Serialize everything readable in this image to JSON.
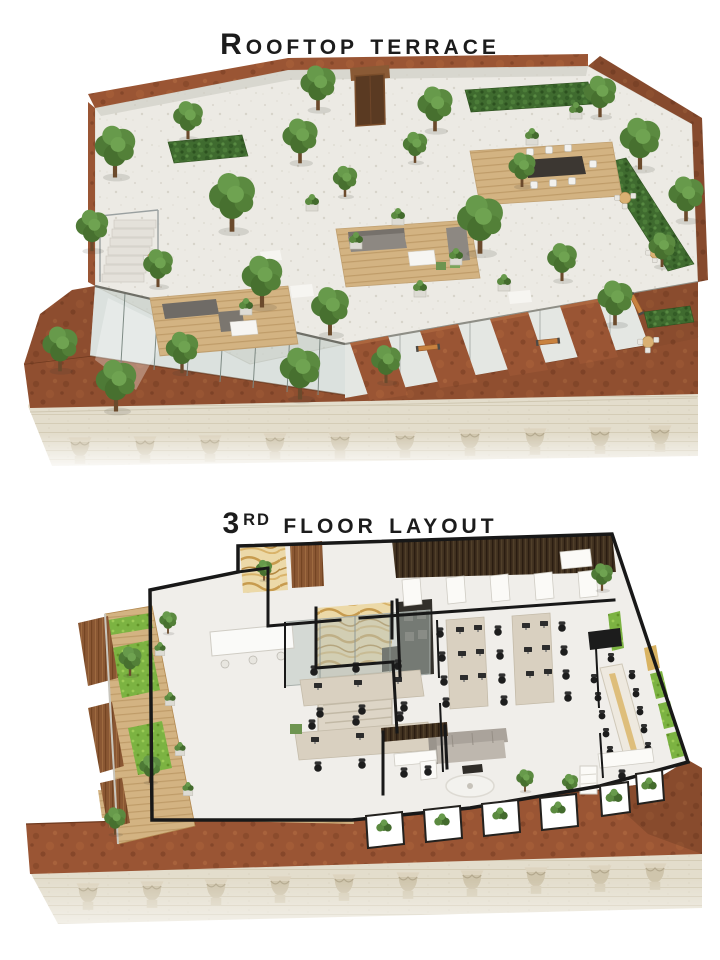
{
  "page": {
    "width": 720,
    "height": 960,
    "background": "#ffffff"
  },
  "sections": [
    {
      "id": "rooftop-terrace",
      "title": "Rooftop terrace",
      "render_alt": "3D aerial render of a rooftop terrace: trees and hedges in planters, wooden lounge decks, dining table, benches, glass railings, corten steel walls and fins, classical stone cornice with column capitals"
    },
    {
      "id": "third-floor-layout",
      "title_number": "3",
      "title_ordinal": "rd",
      "title_rest": "floor layout",
      "render_alt": "3D cutaway plan of the 3rd floor: open-plan offices with desks and task chairs, reception, gold marble lobby, staircase, kitchen, meeting room with long table, lounge sofa, planted balconies above a classical stone facade"
    }
  ],
  "palette": {
    "title_text": "#1c1c1c",
    "corten_rust": "#9a5534",
    "corten_dark": "#7e4226",
    "stone_facade": "#e3ddcc",
    "roof_floor": "#eceae4",
    "tree_green": "#4e7a36",
    "hedge_green": "#3f6b2f",
    "grass_green": "#7cb342",
    "wood_deck": "#d3b382",
    "marble_gold": "#d9b362",
    "glass_tint": "#b7c3bd",
    "wall_black": "#181818"
  }
}
